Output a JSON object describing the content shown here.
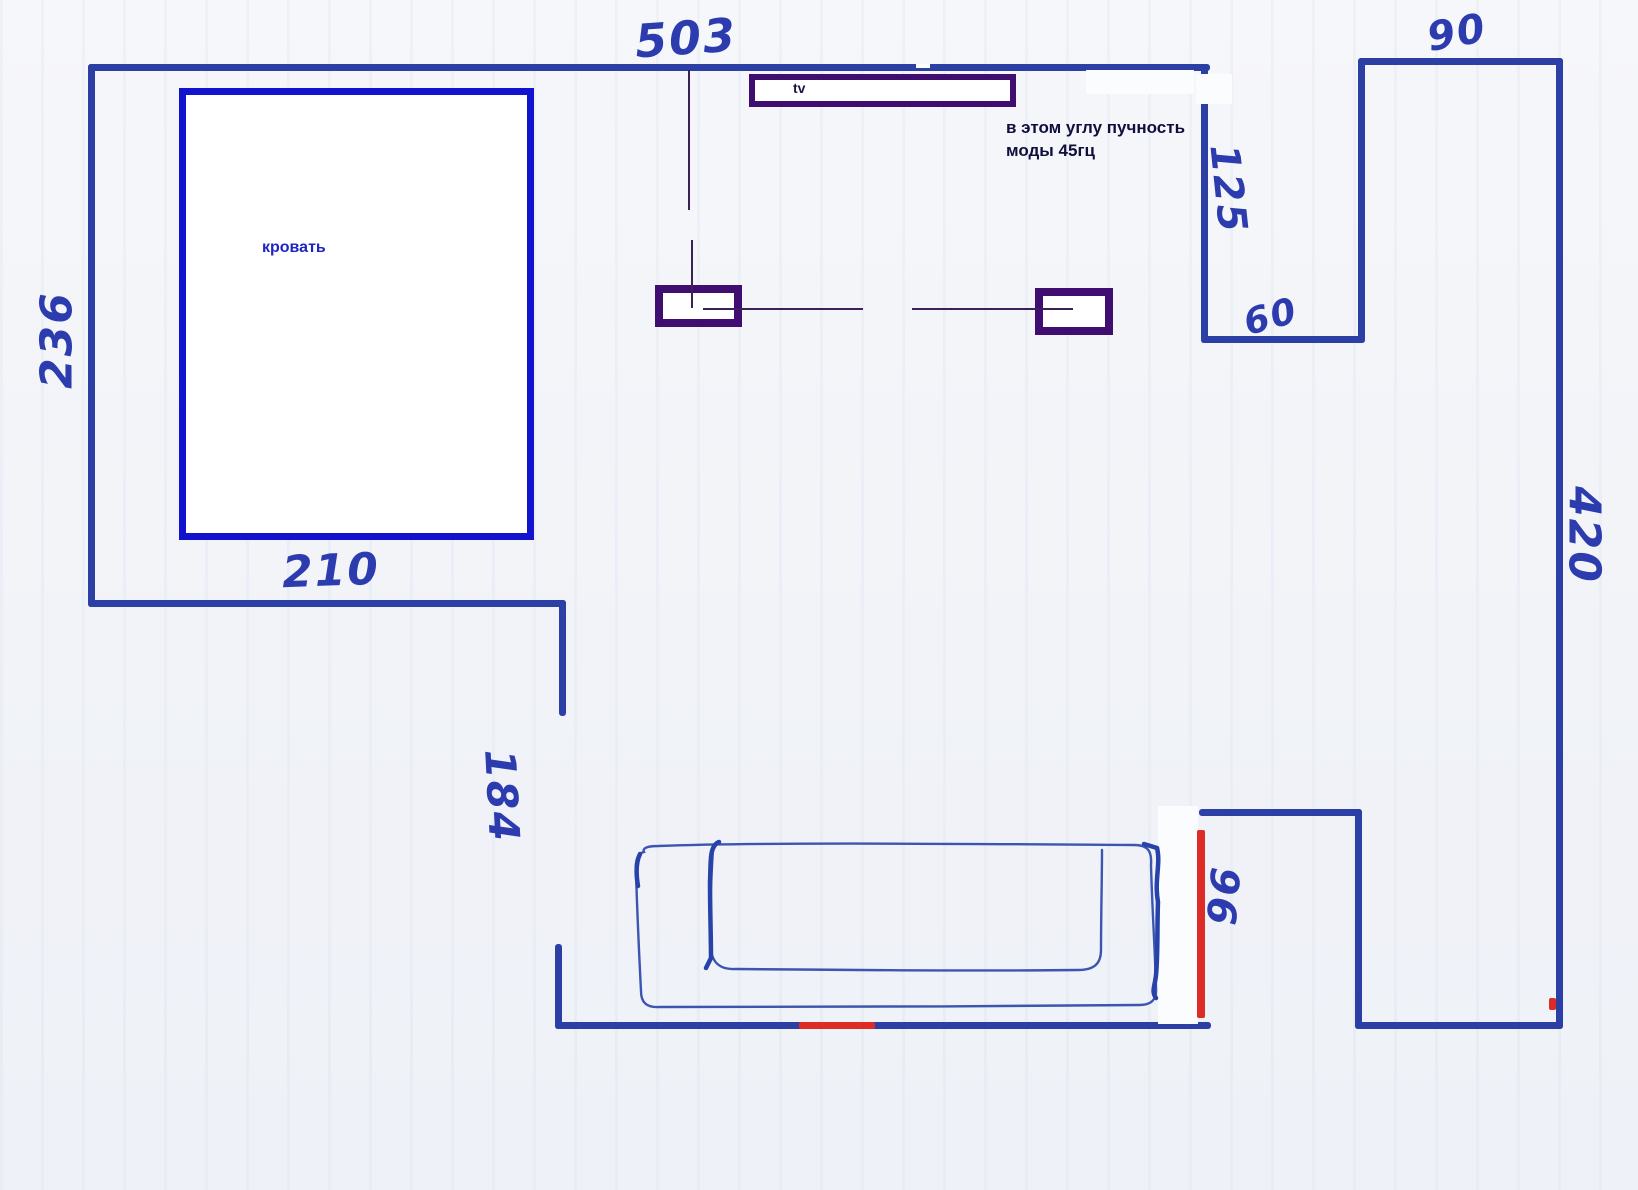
{
  "title": "Hand-drawn room floor plan with acoustic note",
  "dimensions": {
    "top_wall": "503",
    "top_right_wall": "90",
    "left_wall": "236",
    "niche_depth": "125",
    "niche_width": "60",
    "right_wall": "420",
    "bed_wall": "210",
    "passage": "184",
    "doorway": "96"
  },
  "labels": {
    "bed": "кровать",
    "tv": "tv",
    "note_line1": "в этом углу пучность",
    "note_line2": "моды 45гц"
  },
  "colors": {
    "wall_marker": "#2c3fa4",
    "bed_outline": "#1113cf",
    "furniture_outline": "#3f0e70",
    "door_marker_red": "#dd2b26",
    "dimension_text": "#2c3cae",
    "note_text": "#0f0f3d",
    "bed_label_text": "#1f25c4",
    "sofa_stroke": "#3c55b0"
  }
}
